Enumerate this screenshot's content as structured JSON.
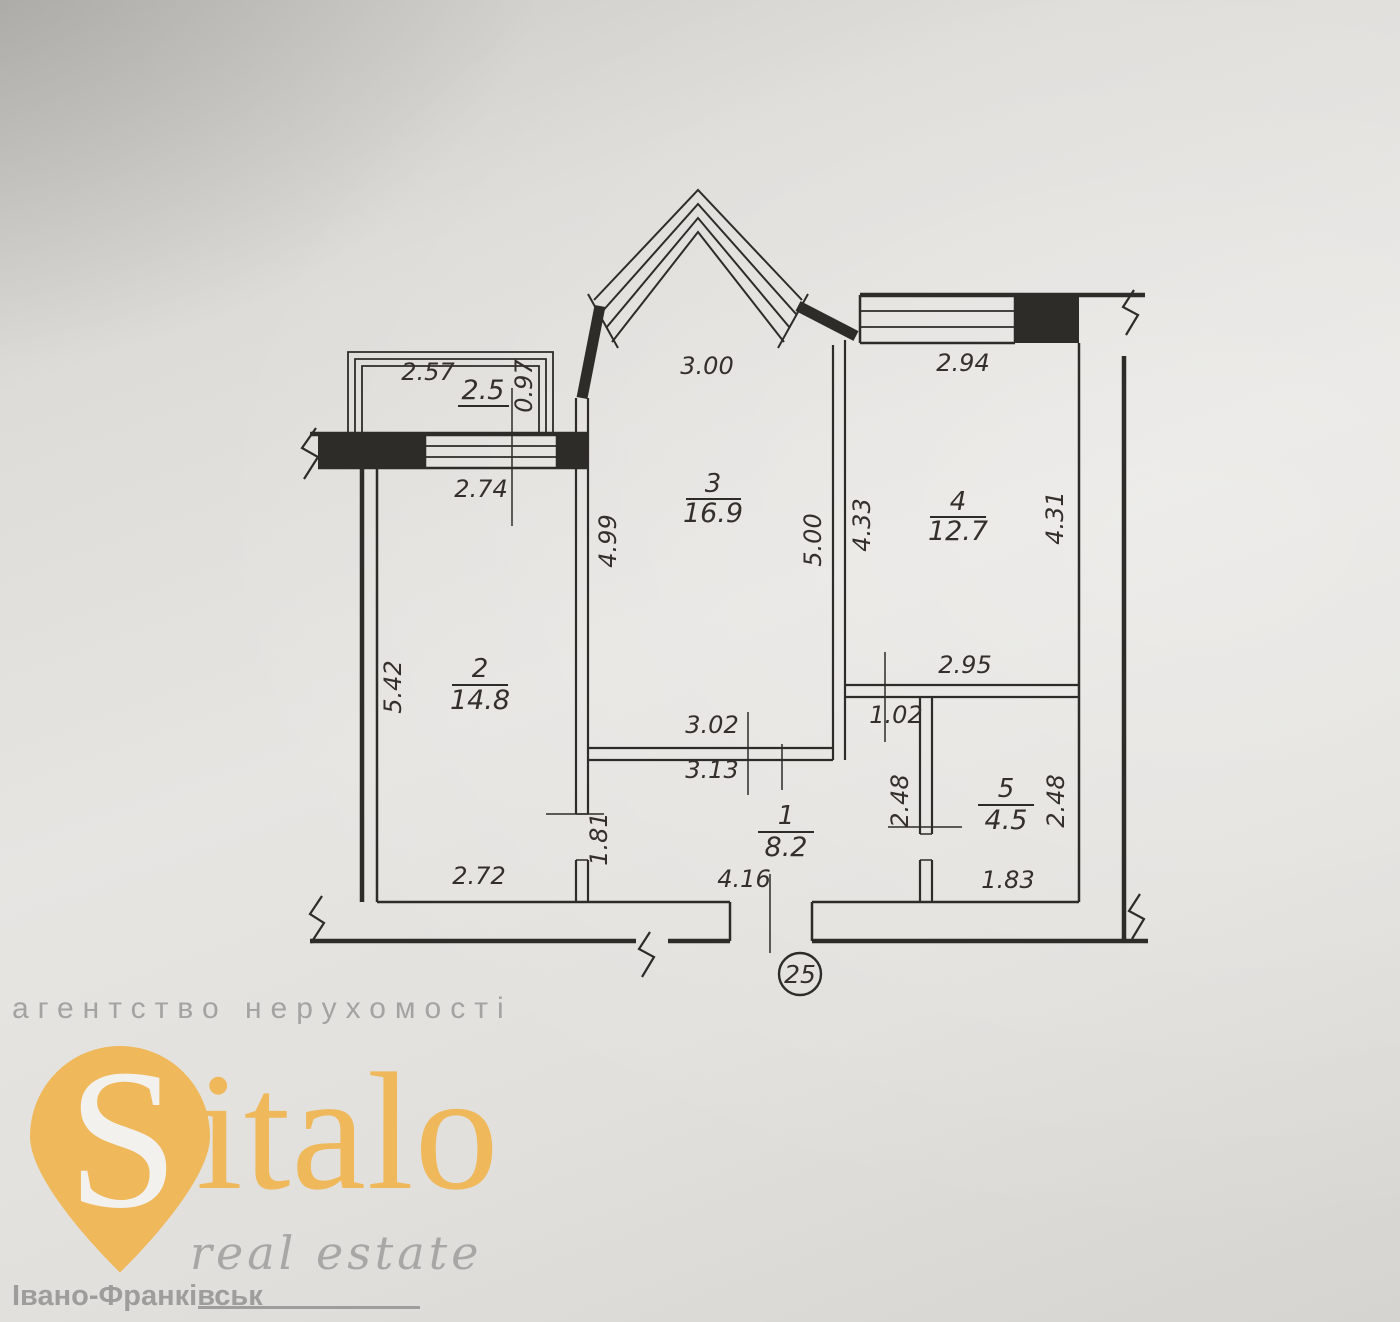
{
  "plan": {
    "unit_number": "25",
    "rooms": {
      "room1": {
        "number": "1",
        "area": "8.2"
      },
      "room2": {
        "number": "2",
        "area": "14.8"
      },
      "room3": {
        "number": "3",
        "area": "16.9"
      },
      "room4": {
        "number": "4",
        "area": "12.7"
      },
      "room5": {
        "number": "5",
        "area": "4.5"
      },
      "balcony": {
        "area": "2.5"
      }
    },
    "dims": {
      "balcony_width": "2.57",
      "balcony_depth": "0.97",
      "left_window_width": "2.74",
      "bay_width": "3.00",
      "right_window_width": "2.94",
      "room3_left_height": "4.99",
      "room3_right_height": "5.00",
      "room4_left_height": "4.33",
      "room4_right_height": "4.31",
      "room2_left_height": "5.42",
      "room4_bottom_width": "2.95",
      "nook_width": "1.02",
      "room3_bottom_width_upper": "3.02",
      "room3_bottom_width_lower": "3.13",
      "room5_left_height": "2.48",
      "room5_right_height": "2.48",
      "room2_door_height": "1.81",
      "room2_bottom_width": "2.72",
      "room1_bottom_width": "4.16",
      "room5_bottom_width": "1.83"
    }
  },
  "watermark": {
    "tagline": "агентство нерухомості",
    "brand_initial": "S",
    "brand_rest": "italo",
    "brand_subtitle": "real estate",
    "city": "Івано-Франківськ",
    "colors": {
      "brand": "#efb85b",
      "muted": "#a3a3a1",
      "line": "#2e2c29"
    }
  }
}
